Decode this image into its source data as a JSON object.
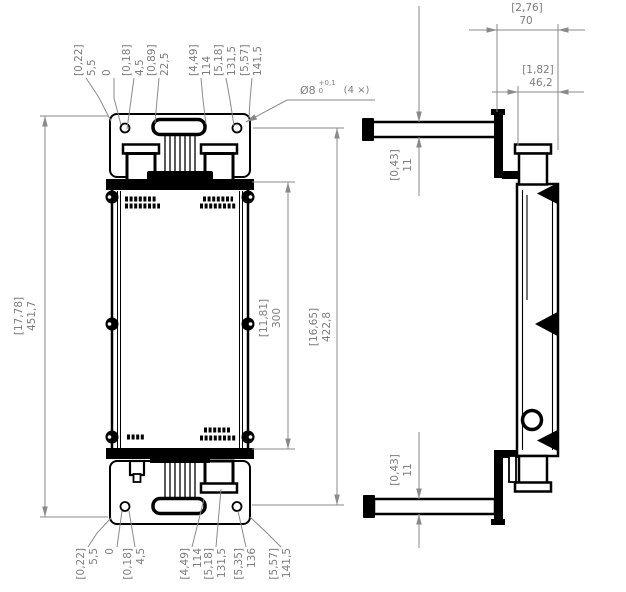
{
  "colors": {
    "line": "#000000",
    "dim_line": "#8a8a8a",
    "dim_text": "#7d7d7d",
    "bg": "#ffffff"
  },
  "hole_callout": {
    "prefix": "Ø8",
    "tol_upper": "+0,1",
    "tol_lower": "0",
    "qty": "(4 ×)"
  },
  "dims": {
    "overall_height": {
      "in": "[17,78]",
      "mm": "451,7"
    },
    "body_height": {
      "in": "[11,81]",
      "mm": "300"
    },
    "mount_span": {
      "in": "[16,65]",
      "mm": "422,8"
    },
    "depth_total": {
      "in": "[2,76]",
      "mm": "70"
    },
    "depth_body": {
      "in": "[1,82]",
      "mm": "46,2"
    },
    "rail_top": {
      "in": "[0,43]",
      "mm": "11"
    },
    "rail_bottom": {
      "in": "[0,43]",
      "mm": "11"
    }
  },
  "top_row": [
    {
      "in": "[0,22]",
      "mm": "5,5"
    },
    {
      "in": "",
      "mm": "0"
    },
    {
      "in": "[0,18]",
      "mm": "4,5"
    },
    {
      "in": "[0,89]",
      "mm": "22,5"
    },
    {
      "in": "[4,49]",
      "mm": "114"
    },
    {
      "in": "[5,18]",
      "mm": "131,5"
    },
    {
      "in": "[5,57]",
      "mm": "141,5"
    }
  ],
  "bottom_row": [
    {
      "in": "[0,22]",
      "mm": "5,5"
    },
    {
      "in": "",
      "mm": "0"
    },
    {
      "in": "[0,18]",
      "mm": "4,5"
    },
    {
      "in": "[4,49]",
      "mm": "114"
    },
    {
      "in": "[5,18]",
      "mm": "131,5"
    },
    {
      "in": "[5,35]",
      "mm": "136"
    },
    {
      "in": "[5,57]",
      "mm": "141,5"
    }
  ]
}
